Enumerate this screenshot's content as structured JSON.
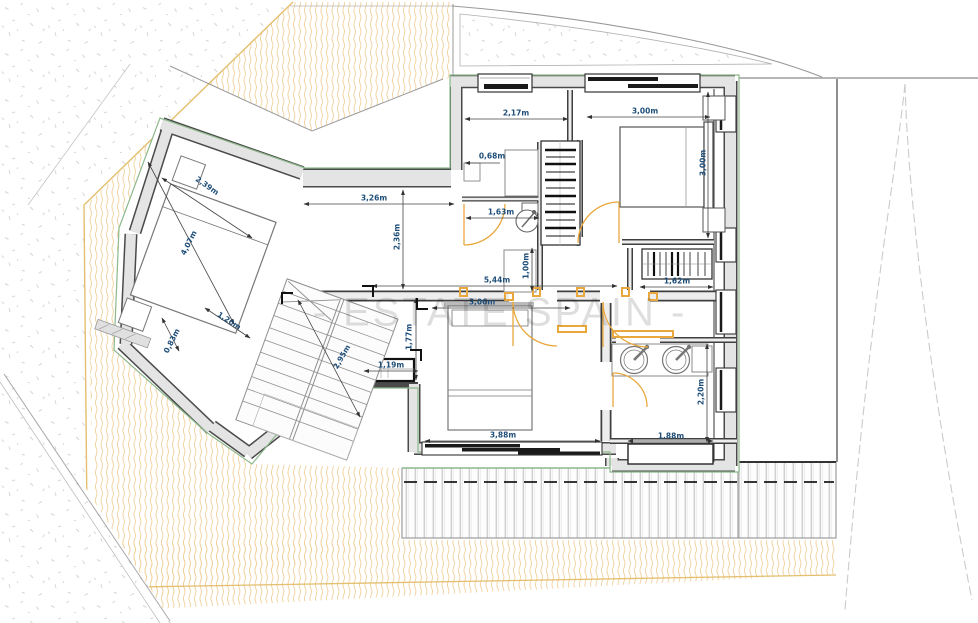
{
  "title": "floor-plan",
  "watermark": "- ESTATE SPAIN -",
  "units": "m",
  "dimensions": [
    {
      "text": "2,17m",
      "x": 516,
      "y": 113,
      "rot": 0
    },
    {
      "text": "3,00m",
      "x": 645,
      "y": 111,
      "rot": 0
    },
    {
      "text": "0,68m",
      "x": 492,
      "y": 156,
      "rot": 0
    },
    {
      "text": "1,63m",
      "x": 501,
      "y": 212,
      "rot": 0
    },
    {
      "text": "3,00m",
      "x": 703,
      "y": 163,
      "rot": -90
    },
    {
      "text": "3,26m",
      "x": 374,
      "y": 198,
      "rot": 0
    },
    {
      "text": "2,36m",
      "x": 397,
      "y": 237,
      "rot": -90
    },
    {
      "text": "1,00m",
      "x": 526,
      "y": 266,
      "rot": -90
    },
    {
      "text": "5,44m",
      "x": 497,
      "y": 280,
      "rot": 0
    },
    {
      "text": "3,06m",
      "x": 482,
      "y": 302,
      "rot": 0
    },
    {
      "text": "1,62m",
      "x": 677,
      "y": 281,
      "rot": 0
    },
    {
      "text": "2,39m",
      "x": 207,
      "y": 186,
      "rot": 35
    },
    {
      "text": "4,07m",
      "x": 189,
      "y": 243,
      "rot": -63
    },
    {
      "text": "1,20m",
      "x": 229,
      "y": 321,
      "rot": 33
    },
    {
      "text": "0,83m",
      "x": 172,
      "y": 341,
      "rot": -63
    },
    {
      "text": "1,77m",
      "x": 409,
      "y": 337,
      "rot": -90
    },
    {
      "text": "2,95m",
      "x": 342,
      "y": 357,
      "rot": -60
    },
    {
      "text": "1,19m",
      "x": 391,
      "y": 365,
      "rot": 0
    },
    {
      "text": "3,88m",
      "x": 503,
      "y": 435,
      "rot": 0
    },
    {
      "text": "1,88m",
      "x": 671,
      "y": 436,
      "rot": 0
    },
    {
      "text": "2,20m",
      "x": 701,
      "y": 392,
      "rot": -90
    }
  ],
  "colors": {
    "wall_fill": "#e4e4e4",
    "wall_edge": "#4a4a4a",
    "exterior_outline_green": "#8cb88c",
    "dimension_text": "#1f4e79",
    "dimension_line": "#444444",
    "door_orange": "#e9a83e",
    "boundary_yellow": "#e3bf6f",
    "hatch_orange": "#f0d09a",
    "deck_line": "#c2c2c2",
    "contour_gray": "#c9c9c9",
    "watermark_gray": "rgba(0,0,0,0.13)"
  }
}
